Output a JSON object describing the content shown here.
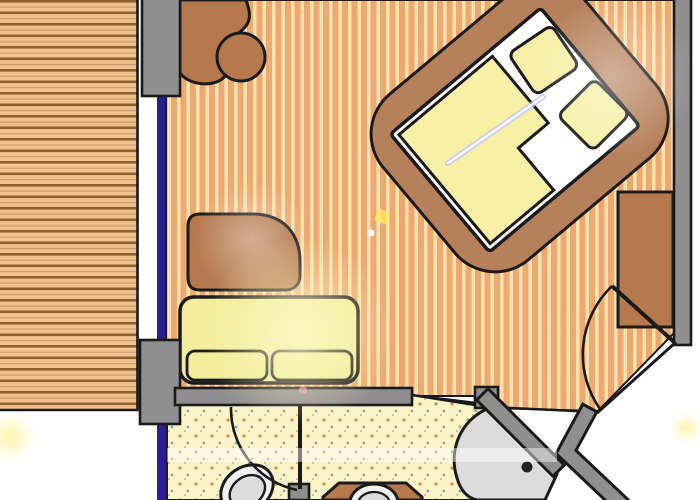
{
  "scene": {
    "type": "floor-plan"
  },
  "colors": {
    "bg": "#ffffff",
    "outline": "#1a1a1a",
    "wall": "#8f8f8f",
    "window_glass": "#2b1f8e",
    "deck_base": "#f2c18d",
    "deck_line_dark": "#8f5f30",
    "deck_line_light": "#c59a69",
    "floor_cream": "#fbe2b0",
    "floor_orange": "#efa96f",
    "bath_base": "#f9f3c8",
    "bath_dot_orange": "#cf8f4e",
    "bath_dot_gray": "#9aa0a8",
    "furniture": "#b5794d",
    "bed_frame": "#b5805a",
    "linen": "#f7f0a5",
    "mattress": "#ffffff",
    "sofa": "#f2ee9a",
    "fixture": "#dcdcdc",
    "fixture_ring": "#f2f2f2",
    "drain": "#222222",
    "glow_warm": "#fff7c8",
    "glow_white": "#ffffff",
    "streak_blue": "#b9c4ff",
    "sparkle_yellow": "#ffe95e",
    "sparkle_pink": "#ffb7d9"
  }
}
